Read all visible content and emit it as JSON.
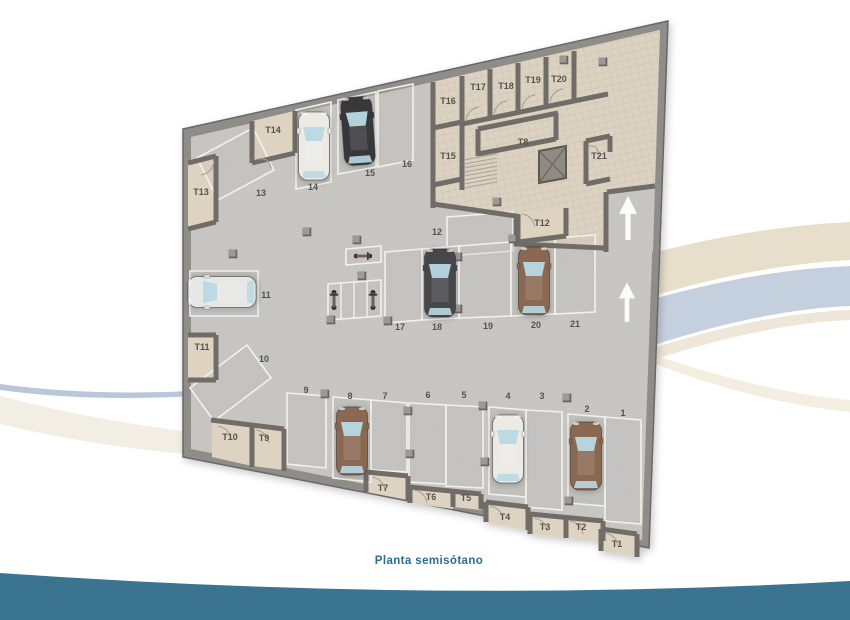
{
  "caption": "Planta semisótano",
  "colors": {
    "accent_teal_band": "#3a7490",
    "caption_text": "#2b6d8e",
    "outer_wall": "#8f8d89",
    "concrete_floor": "#c9c8c5",
    "tiled_corridor": "#dcd2c1",
    "swoosh_beige": "#e8decc",
    "swoosh_blue": "#c5d0de"
  },
  "plan": {
    "parking": {
      "p1": "1",
      "p2": "2",
      "p3": "3",
      "p4": "4",
      "p5": "5",
      "p6": "6",
      "p7": "7",
      "p8": "8",
      "p9": "9",
      "p10": "10",
      "p11": "11",
      "p12": "12",
      "p13": "13",
      "p14": "14",
      "p15": "15",
      "p16": "16",
      "p17": "17",
      "p18": "18",
      "p19": "19",
      "p20": "20",
      "p21": "21"
    },
    "storage": {
      "t1": "T1",
      "t2": "T2",
      "t3": "T3",
      "t4": "T4",
      "t5": "T5",
      "t6": "T6",
      "t7": "T7",
      "t8": "T8",
      "t9": "T9",
      "t10": "T10",
      "t11": "T11",
      "t12": "T12",
      "t13": "T13",
      "t14": "T14",
      "t15": "T15",
      "t16": "T16",
      "t17": "T17",
      "t18": "T18",
      "t19": "T19",
      "t20": "T20",
      "t21": "T21"
    },
    "cars": [
      {
        "space": "2",
        "color": "brown"
      },
      {
        "space": "4",
        "color": "white"
      },
      {
        "space": "8",
        "color": "brown"
      },
      {
        "space": "11",
        "color": "silver"
      },
      {
        "space": "14",
        "color": "white"
      },
      {
        "space": "15",
        "color": "black"
      },
      {
        "space": "18",
        "color": "dark-gray"
      },
      {
        "space": "20",
        "color": "brown"
      }
    ],
    "motorcycles": 3,
    "direction_arrows": [
      {
        "location": "ramp-top-right",
        "direction": "up"
      },
      {
        "location": "right-aisle",
        "direction": "up"
      }
    ]
  }
}
